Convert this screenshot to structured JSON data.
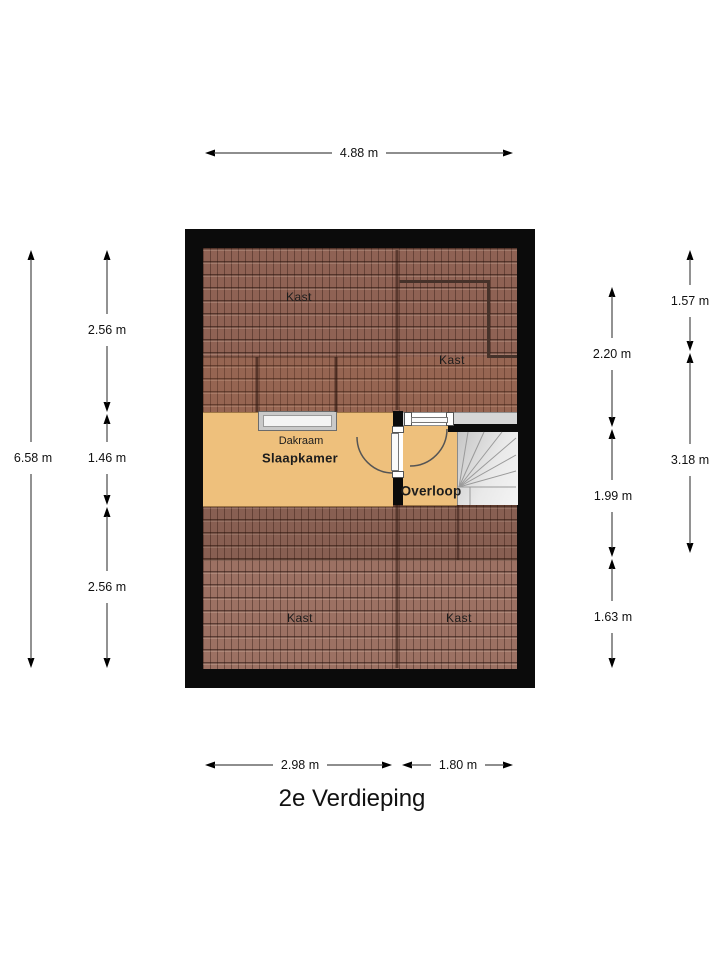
{
  "title": "2e Verdieping",
  "floorplan": {
    "rooms": {
      "kast_top_left": "Kast",
      "kast_top_right": "Kast",
      "dakraam": "Dakraam",
      "slaapkamer": "Slaapkamer",
      "overloop": "Overloop",
      "kast_bottom_left": "Kast",
      "kast_bottom_right": "Kast"
    },
    "dimensions": {
      "top_width": "4.88 m",
      "left_total": "6.58 m",
      "left_top": "2.56 m",
      "left_middle": "1.46 m",
      "left_bottom": "2.56 m",
      "right_inner_top": "2.20 m",
      "right_inner_middle": "1.99 m",
      "right_inner_bottom": "1.63 m",
      "right_outer_top": "1.57 m",
      "right_outer_bottom": "3.18 m",
      "bottom_left": "2.98 m",
      "bottom_right": "1.80 m"
    },
    "colors": {
      "outer_wall": "#0b0b0b",
      "roof_tile_top": "#8f6254",
      "roof_tile_bottom": "#9c7163",
      "floor": "#eec07c",
      "stairs": "#d9d9d9",
      "knee_wall": "#d6d6d6"
    }
  }
}
